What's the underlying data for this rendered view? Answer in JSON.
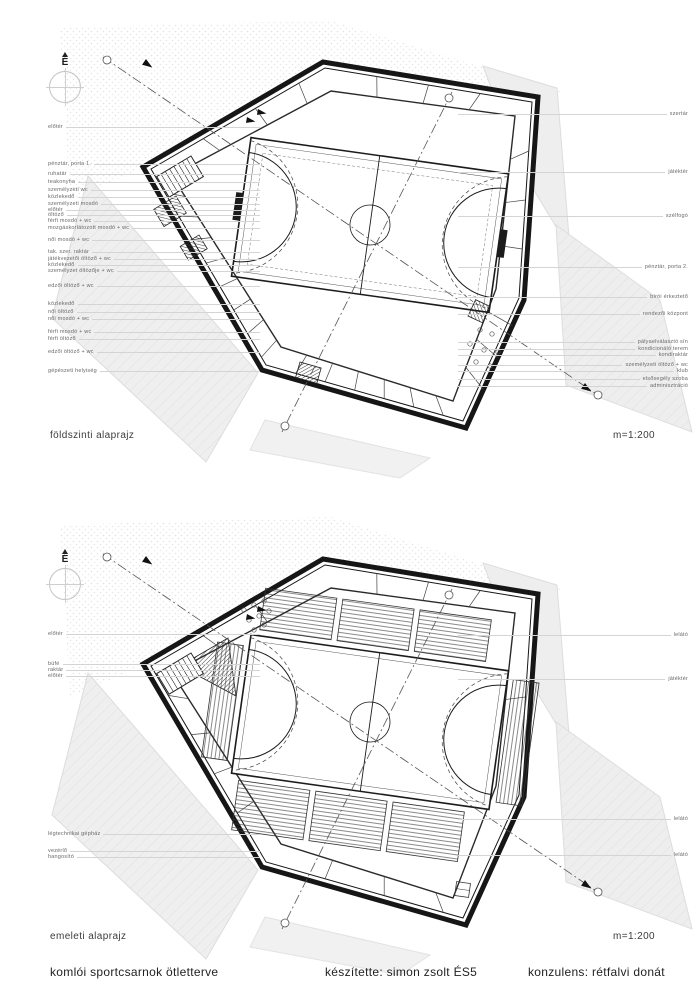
{
  "footer": {
    "project": "komlói sportcsarnok ötletterve",
    "author": "készítette: simon zsolt ÉS5",
    "consultant": "konzulens: rétfalvi donát"
  },
  "plans": [
    {
      "title": "földszinti alaprajz",
      "scale": "m=1:200",
      "north_label": "É",
      "left_labels": [
        {
          "text": "előtér",
          "y": 128
        },
        {
          "text": "pénztár, porta 1.",
          "y": 165
        },
        {
          "text": "ruhatár",
          "y": 175
        },
        {
          "text": "teakonyha",
          "y": 183
        },
        {
          "text": "személyzeti wc",
          "y": 191
        },
        {
          "text": "közlekedő",
          "y": 198
        },
        {
          "text": "személyzeti mosdó",
          "y": 205
        },
        {
          "text": "előtér",
          "y": 211
        },
        {
          "text": "öltöző",
          "y": 216
        },
        {
          "text": "férfi mosdó + wc",
          "y": 222
        },
        {
          "text": "mozgáskorlátozott mosdó + wc",
          "y": 229
        },
        {
          "text": "női mosdó + wc",
          "y": 241
        },
        {
          "text": "tak. szer. raktár",
          "y": 253
        },
        {
          "text": "játékvezetői öltöző + wc",
          "y": 260
        },
        {
          "text": "közlekedő",
          "y": 266
        },
        {
          "text": "személyzet öltözője + wc",
          "y": 272
        },
        {
          "text": "edzői öltöző + wc",
          "y": 287
        },
        {
          "text": "közlekedő",
          "y": 305
        },
        {
          "text": "női öltöző",
          "y": 313
        },
        {
          "text": "női mosdó + wc",
          "y": 320
        },
        {
          "text": "férfi mosdó + wc",
          "y": 333
        },
        {
          "text": "férfi öltöző",
          "y": 340
        },
        {
          "text": "edzői öltöző + wc",
          "y": 353
        },
        {
          "text": "gépészeti helyiség",
          "y": 372
        }
      ],
      "right_labels": [
        {
          "text": "szertár",
          "y": 115
        },
        {
          "text": "játéktér",
          "y": 173
        },
        {
          "text": "szélfogó",
          "y": 217
        },
        {
          "text": "pénztár, porta 2.",
          "y": 268
        },
        {
          "text": "bírói érkeztető",
          "y": 298
        },
        {
          "text": "rendezői központ",
          "y": 315
        },
        {
          "text": "pályaelválasztó sín",
          "y": 343
        },
        {
          "text": "kondicionáló terem",
          "y": 350
        },
        {
          "text": "kondiraktár",
          "y": 356
        },
        {
          "text": "személyzeti öltöző + wc",
          "y": 366
        },
        {
          "text": "klub",
          "y": 372
        },
        {
          "text": "elsősegély szoba",
          "y": 380
        },
        {
          "text": "adminisztráció",
          "y": 387
        }
      ]
    },
    {
      "title": "emeleti alaprajz",
      "scale": "m=1:200",
      "north_label": "É",
      "left_labels": [
        {
          "text": "előtér",
          "y": 635
        },
        {
          "text": "büfé",
          "y": 665
        },
        {
          "text": "raktár",
          "y": 671
        },
        {
          "text": "előtér",
          "y": 677
        },
        {
          "text": "légtechnikai gépház",
          "y": 835
        },
        {
          "text": "vezérlő",
          "y": 852
        },
        {
          "text": "hangosító",
          "y": 858
        }
      ],
      "right_labels": [
        {
          "text": "lelátó",
          "y": 636
        },
        {
          "text": "játéktér",
          "y": 680
        },
        {
          "text": "lelátó",
          "y": 820
        },
        {
          "text": "lelátó",
          "y": 856
        }
      ]
    }
  ],
  "colors": {
    "ink": "#161616",
    "terrain_fill": "#efefef",
    "leader_line": "#d4d4d4",
    "label_text": "#6a6a6a"
  }
}
